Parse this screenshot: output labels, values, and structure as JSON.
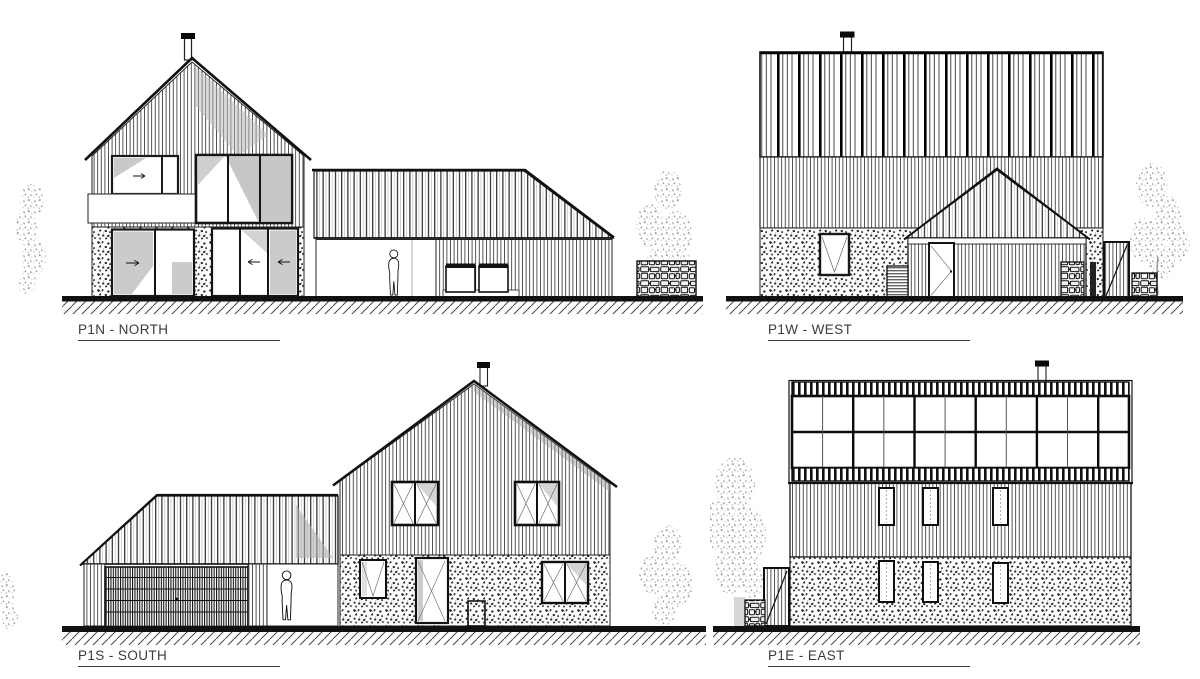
{
  "sheet": {
    "type": "architectural-elevations",
    "background": "#ffffff",
    "line_color": "#1a1a1a",
    "glass_tint": "#c9c9c9",
    "foliage_color": "#9c9c9c",
    "label_color": "#3b3b3b"
  },
  "elevations": {
    "north": {
      "label": "P1N - NORTH"
    },
    "west": {
      "label": "P1W - WEST"
    },
    "south": {
      "label": "P1S - SOUTH"
    },
    "east": {
      "label": "P1E - EAST"
    }
  }
}
